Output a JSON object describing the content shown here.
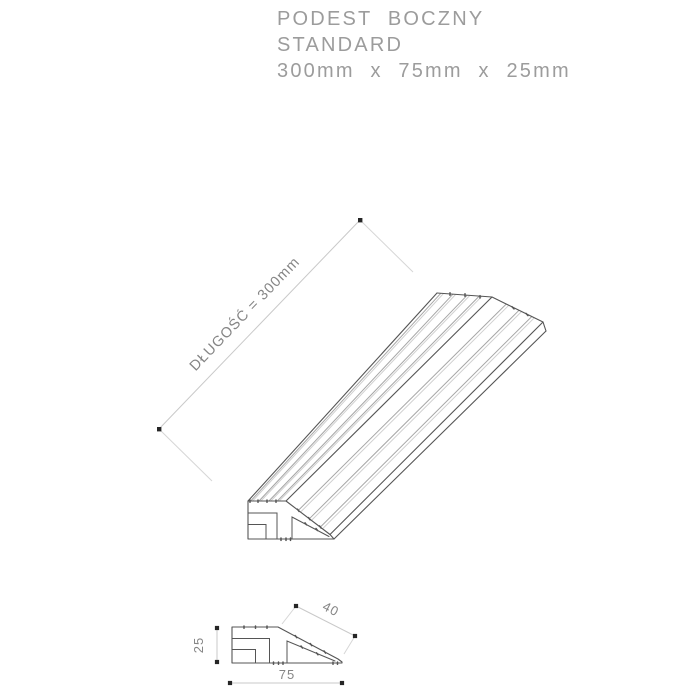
{
  "title": {
    "line1": "PODEST BOCZNY",
    "line2": "STANDARD",
    "line3": "300mm x 75mm x 25mm"
  },
  "dimensions": {
    "length_label": "DŁUGOŚĆ = 300mm",
    "slope_width_label": "40",
    "base_width_label": "75",
    "height_label": "25"
  },
  "colors": {
    "title": "#9c9c9c",
    "outline": "#555555",
    "groove_dark": "#a6a6a6",
    "groove_light": "#d0d0d0",
    "dim": "#c9c9c9",
    "ext": "#d6d6d6",
    "dot": "#262626",
    "dimtext": "#858585",
    "background": "#ffffff"
  }
}
